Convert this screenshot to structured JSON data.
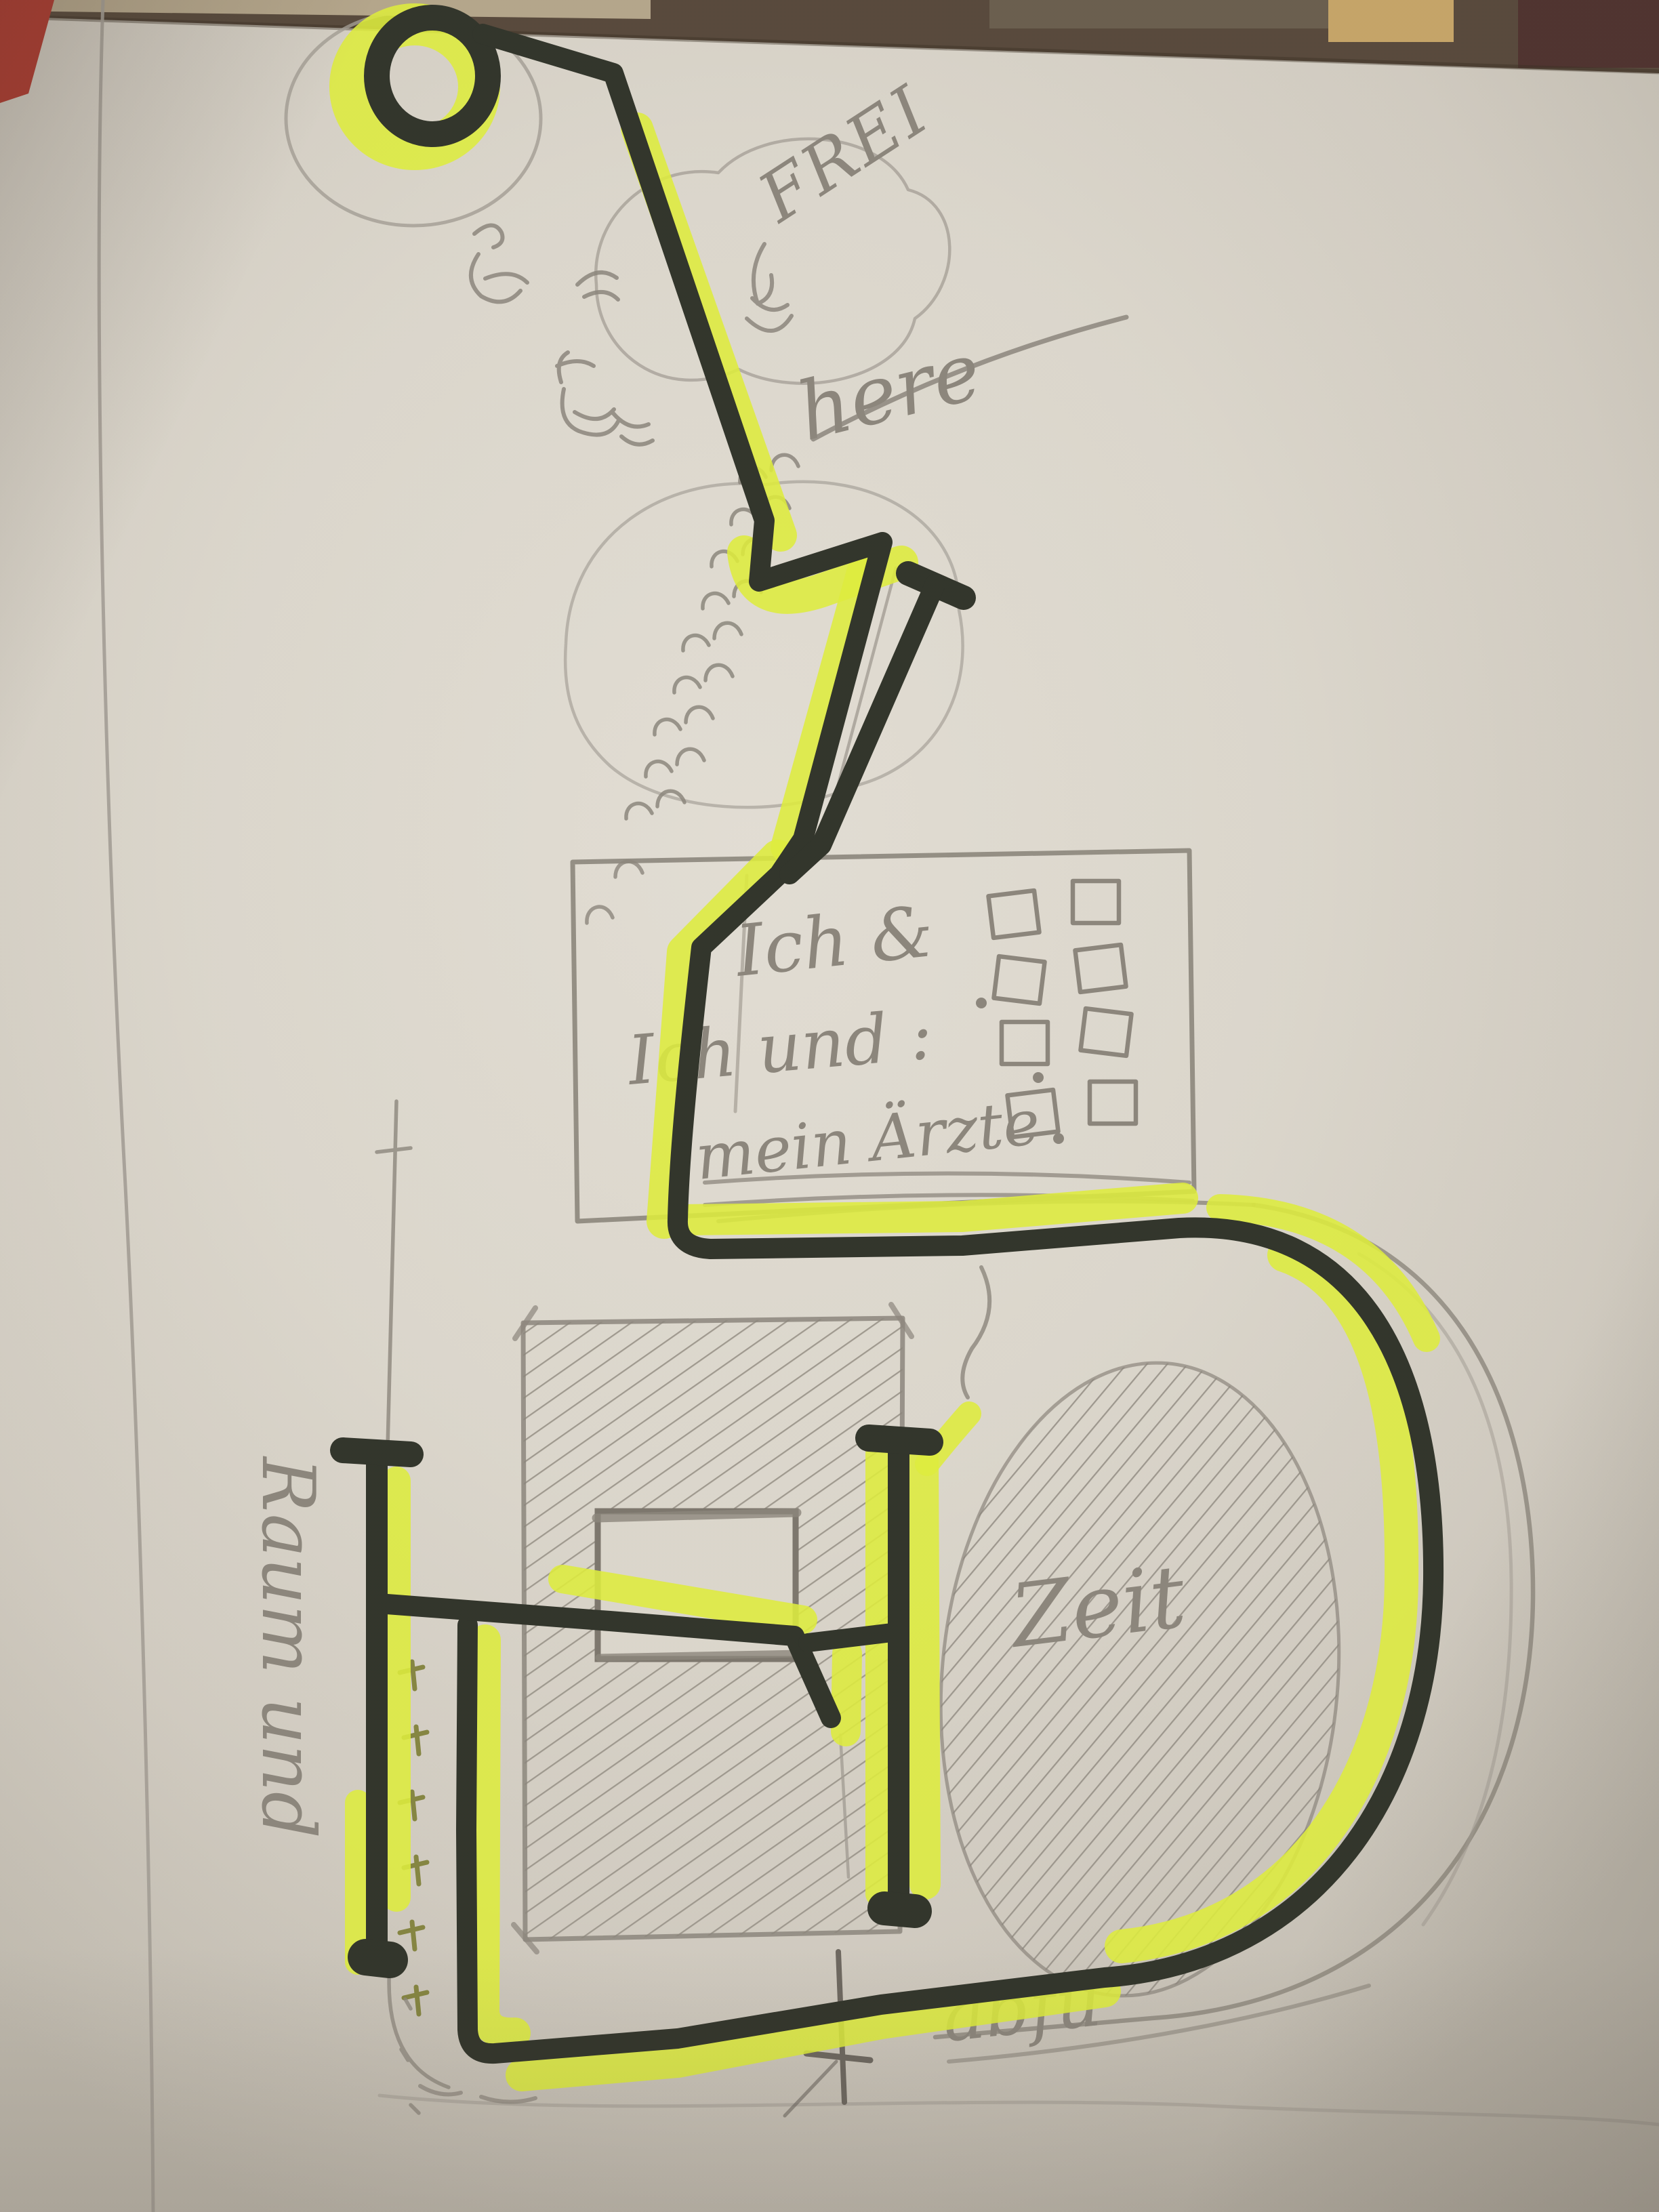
{
  "photo": {
    "scene": "Hand-drawn sketch on paper: black marker route highlighted in neon yellow over pencil doodles, photographed on a dark table",
    "texts": {
      "frei": "FREI",
      "here": "here",
      "box_line1": "Ich &",
      "box_line2": "Ich und :",
      "box_line3": "mein Ärzte",
      "oval_label": "Zeit",
      "margin_note": "Raum und",
      "bottom_note": "abfu"
    },
    "doodles": {
      "checkbox_count": 8,
      "chevron_count": 9,
      "tick_count": 6,
      "dot_count": 3
    },
    "colors": {
      "paper": "#dfdbd2",
      "marker_black": "#2f332b",
      "highlighter_yellow": "#e3f23d",
      "pencil_gray": "#8d8880",
      "table_dark": "#55493f",
      "table_tan": "#c9a76b",
      "corner_red": "#b03a31"
    }
  }
}
